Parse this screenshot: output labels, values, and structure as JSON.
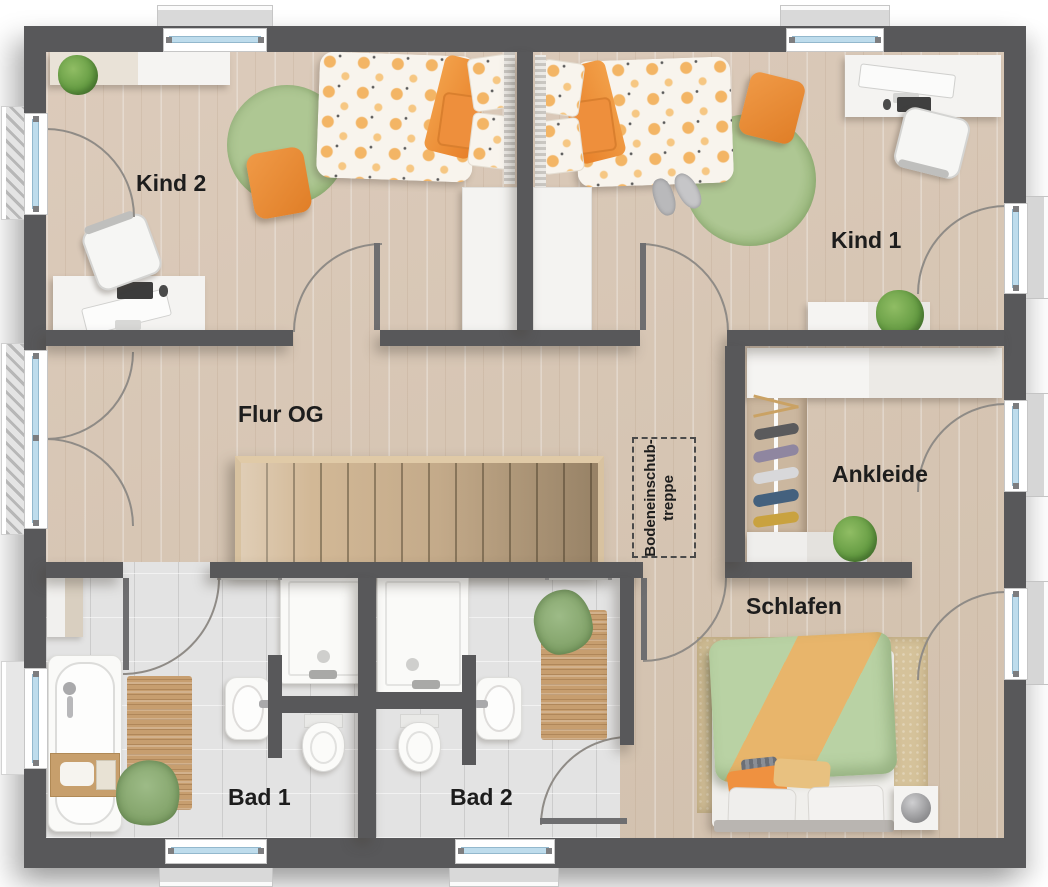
{
  "rooms": {
    "kind2": {
      "label": "Kind 2"
    },
    "kind1": {
      "label": "Kind 1"
    },
    "flur": {
      "label": "Flur OG"
    },
    "ankleide": {
      "label": "Ankleide"
    },
    "schlafen": {
      "label": "Schlafen"
    },
    "bad1": {
      "label": "Bad 1"
    },
    "bad2": {
      "label": "Bad 2"
    }
  },
  "attic_hatch": {
    "line1": "Bodeneinschub-",
    "line2": "treppe"
  },
  "colors": {
    "wall": "#58585a",
    "wood_floor": "#d9c8b6",
    "stair_wood": "#cdb28e",
    "tile_floor": "#e3e3e3",
    "accent_orange": "#ee913d",
    "rug_green": "#a7c38b",
    "bed_green": "#b7d1a2",
    "blanket_orange": "#e7b369",
    "rug_beige": "#d5c29a",
    "window_glass": "#bedcec",
    "label_text": "#1d1d1d"
  }
}
